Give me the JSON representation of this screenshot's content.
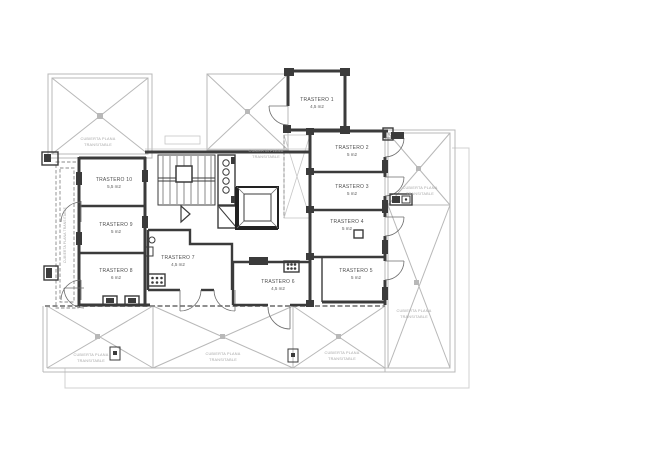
{
  "rooms": [
    {
      "name": "TRASTERO 1",
      "area": "4,5 m2"
    },
    {
      "name": "TRASTERO 2",
      "area": "5 m2"
    },
    {
      "name": "TRASTERO 3",
      "area": "5 m2"
    },
    {
      "name": "TRASTERO 4",
      "area": "5 m2"
    },
    {
      "name": "TRASTERO 5",
      "area": "5 m2"
    },
    {
      "name": "TRASTERO 6",
      "area": "4,5 m2"
    },
    {
      "name": "TRASTERO 7",
      "area": "4,5 m2"
    },
    {
      "name": "TRASTERO 8",
      "area": "6 m2"
    },
    {
      "name": "TRASTERO 9",
      "area": "5 m2"
    },
    {
      "name": "TRASTERO 10",
      "area": "5,5 m2"
    }
  ],
  "terrace": {
    "line1": "CUBIERTA PLANA",
    "line2": "TRANSITABLE",
    "vertical": "CUBIERTA PLANA TRANSITABLE"
  },
  "colors": {
    "wall": "#3b3b3b",
    "light_line": "#b8b8b8",
    "terrace_text": "#a6a6a6",
    "room_text": "#4f4f4f",
    "paper": "#ffffff"
  }
}
